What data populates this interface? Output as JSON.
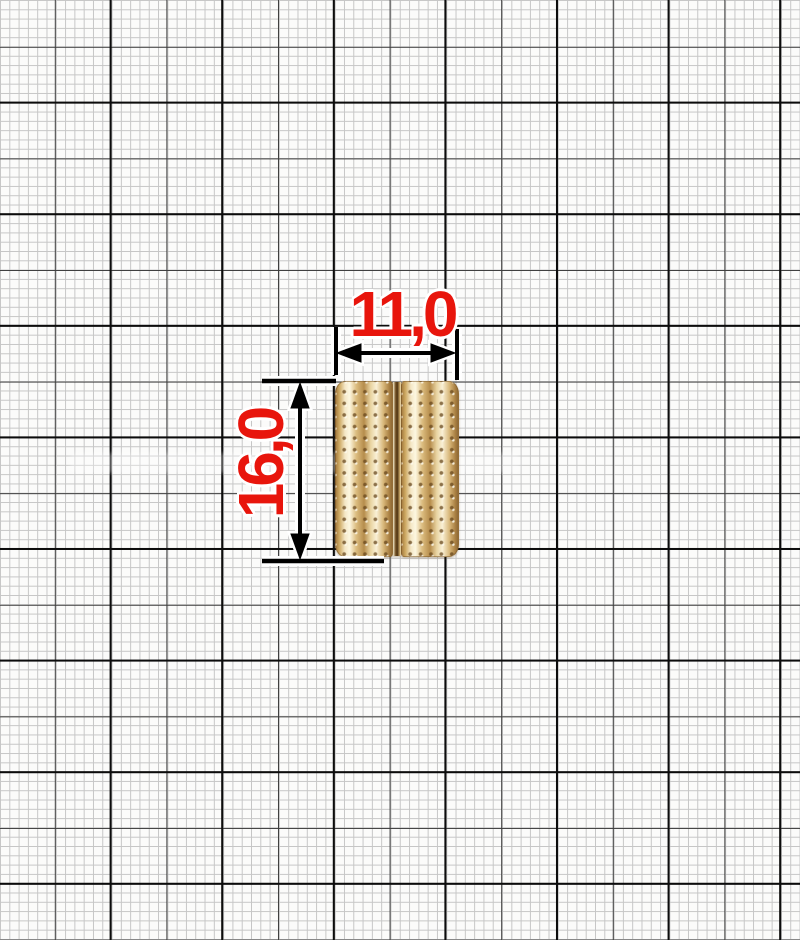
{
  "figure": {
    "kind": "product dimension diagram on millimeter graph paper",
    "product": "gold perforated two-rib strap fixator"
  },
  "dimensions": {
    "horizontal": {
      "label": "11,0"
    },
    "vertical": {
      "label": "16,0"
    },
    "text_color": "#e8150c",
    "line_color": "#000000"
  },
  "grid": {
    "background": "#fbfbfa",
    "fine_line_color": "#c6c6c6",
    "medium_line_color": "#3d3d3d",
    "major_line_color": "#0c0c0c"
  },
  "object_colors": {
    "highlight": "#fdf7e1",
    "base_gold": "#dcbd80",
    "shadow": "#8f6a35",
    "groove": "#4f3413"
  }
}
